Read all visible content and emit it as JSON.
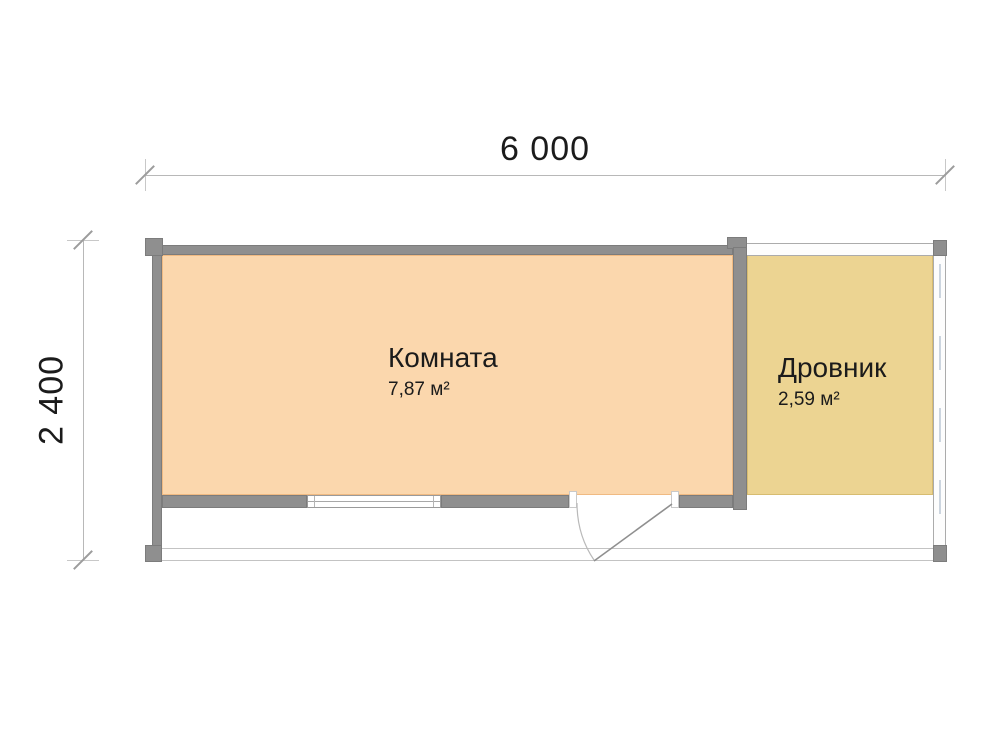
{
  "plan": {
    "dim_width": "6 000",
    "dim_height": "2 400",
    "rooms": [
      {
        "name": "Комната",
        "area": "7,87 м²"
      },
      {
        "name": "Дровник",
        "area": "2,59 м²"
      }
    ]
  },
  "colors": {
    "room_fill": "#fbd7ad",
    "shed_fill": "#ecd492",
    "wall": "#8f8f8f",
    "dim_line": "#b8b8b8",
    "text": "#1b1b1b"
  }
}
